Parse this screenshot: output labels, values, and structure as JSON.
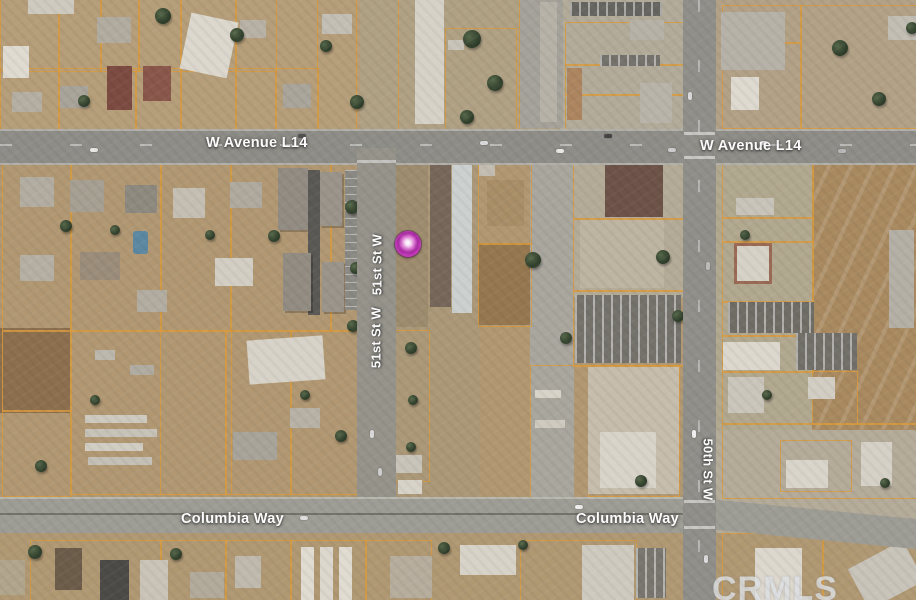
{
  "map": {
    "kind": "aerial-satellite-parcel-map",
    "streets": {
      "avenue_l14": "W Avenue L14",
      "columbia_way": "Columbia Way",
      "street_51st": "51st St W",
      "street_50th": "50th St W"
    },
    "watermark": "CRMLS",
    "highlight_parcel": {
      "shape": "narrow vertical rectangle",
      "outline_color": "#f3e511"
    },
    "marker": {
      "shape": "circle",
      "color": "#b535ac"
    },
    "colors": {
      "terrain": "#b29872",
      "road": "#8e8d87",
      "lot-line": "#d89a3e",
      "label-text": "#ffffff",
      "highlight": "#f3e511",
      "watermark-color": "#dde0e4"
    }
  }
}
